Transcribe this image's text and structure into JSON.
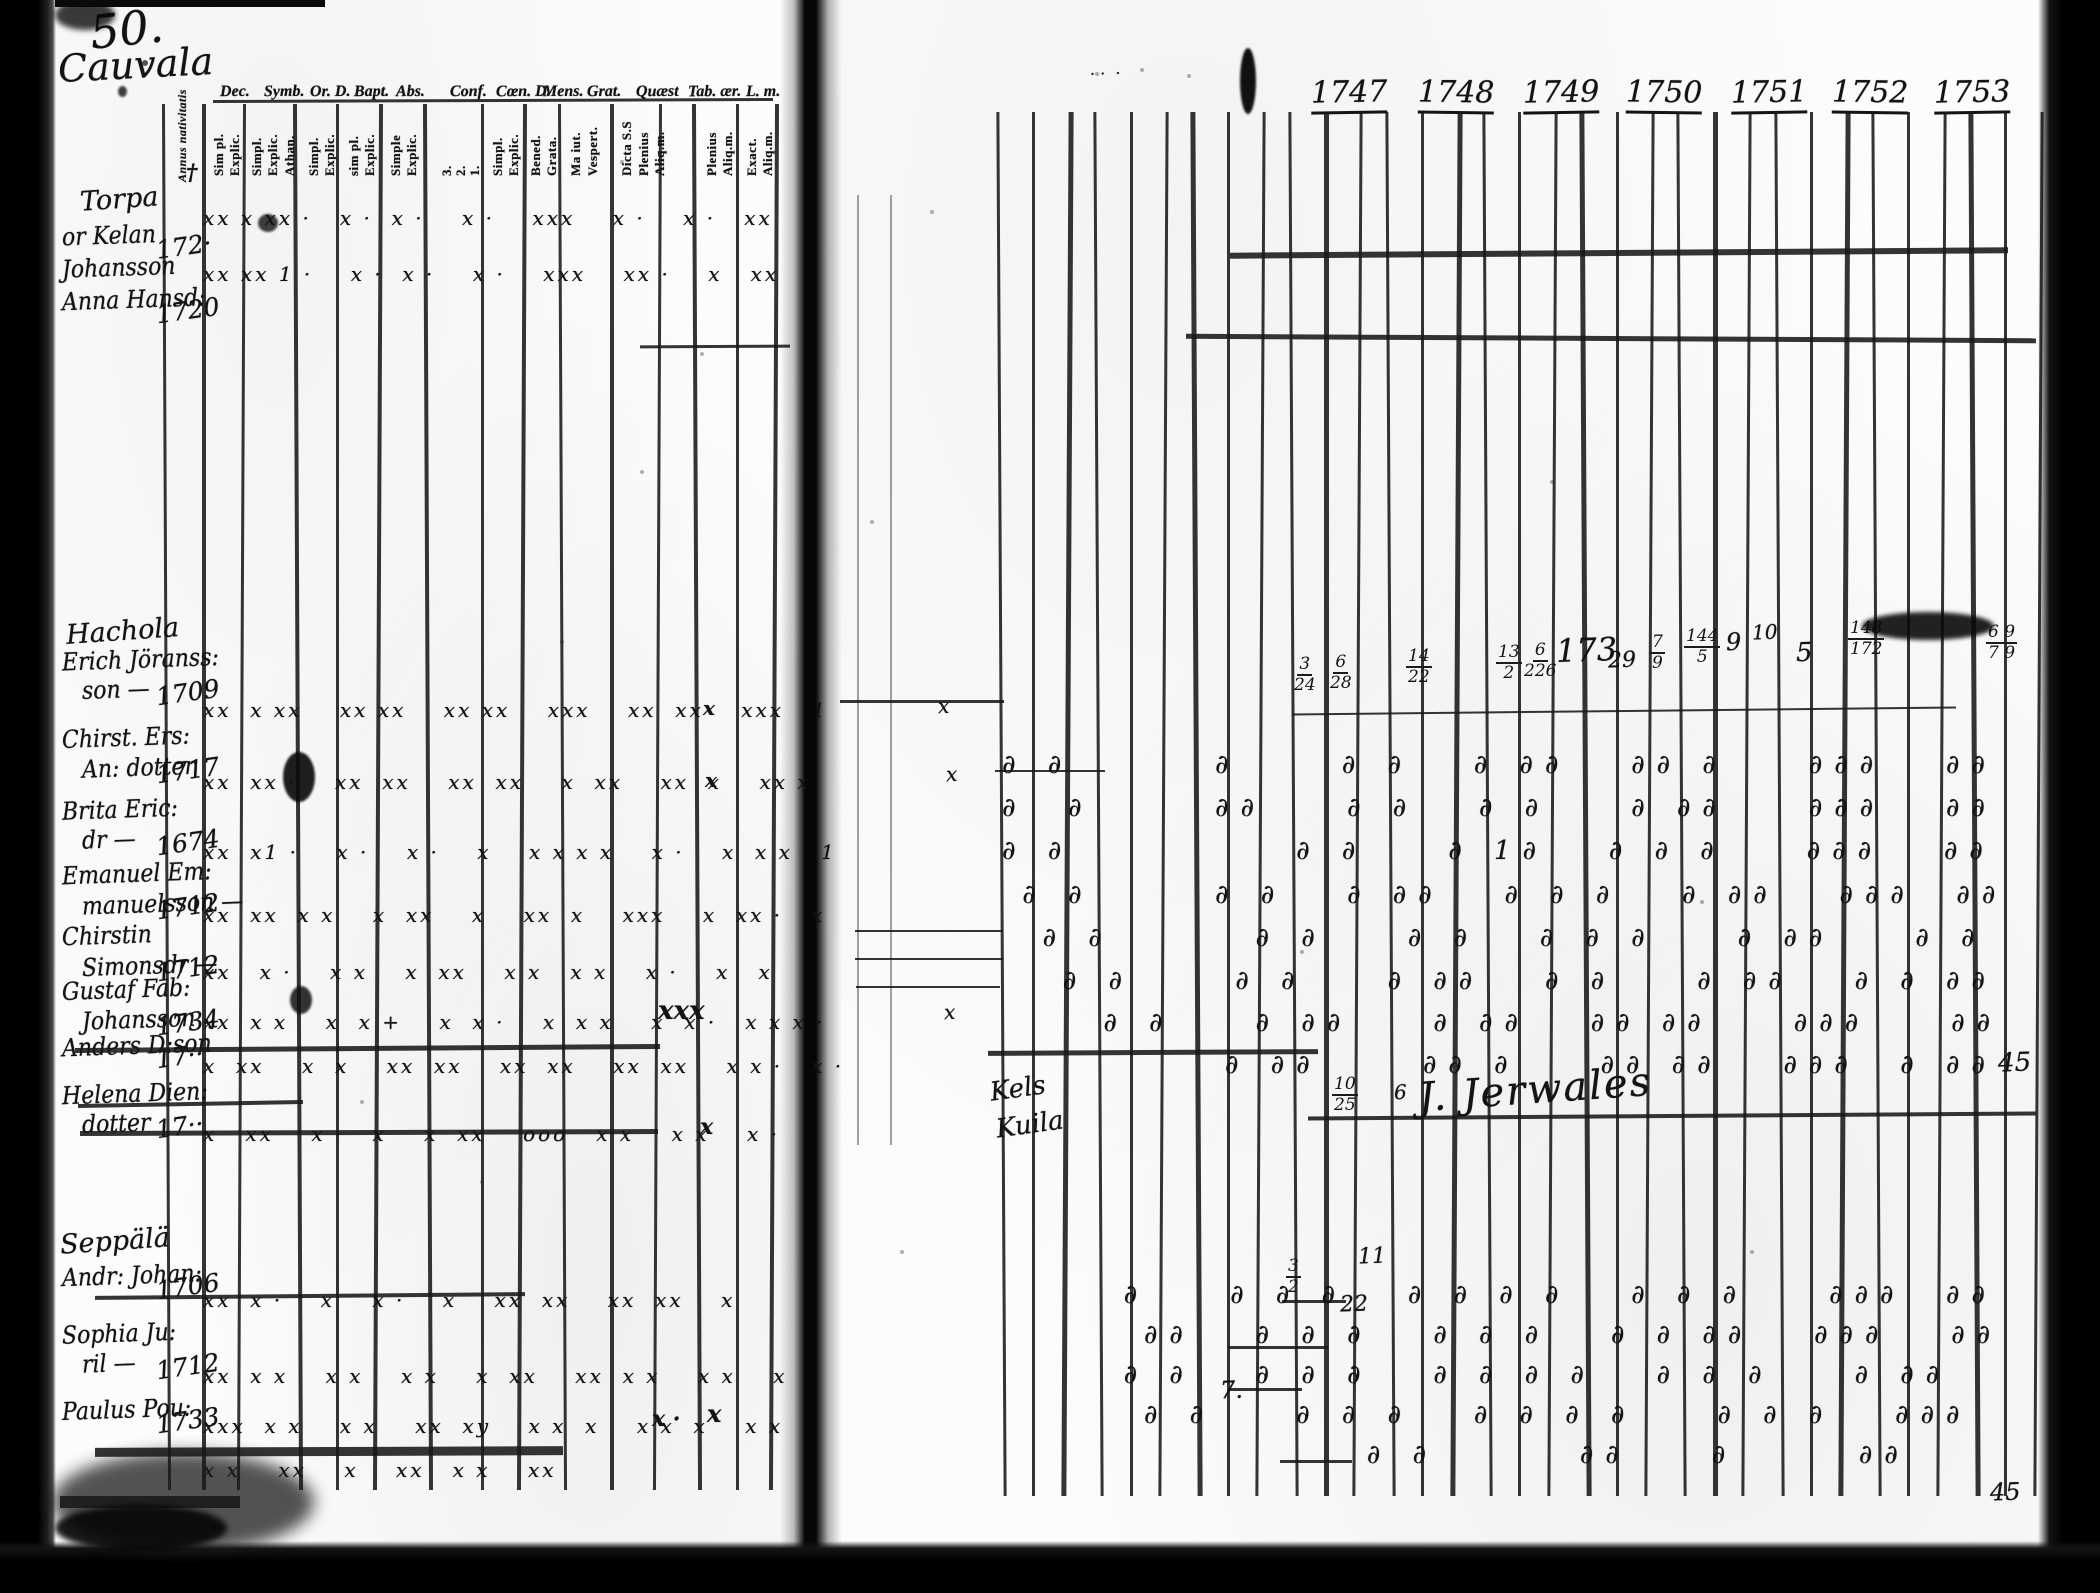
{
  "scan": {
    "page_number": "50.",
    "place_title": "Cauvala",
    "left_page": {
      "group_headers": [
        "Dec.",
        "Symb.",
        "Or. D.",
        "Bapt.",
        "Abs.",
        "Conf.",
        "Cœn. D.",
        "Mens.",
        "Grat.",
        "Quæst",
        "Tab. ær.",
        "L. m."
      ],
      "first_column_label": "Annus nativitatis",
      "sub_headers": [
        "Sim pl.",
        "Explic.",
        "Simpl.",
        "Explic.",
        "Athan.",
        "Simpl.",
        "Explic.",
        "sim pl.",
        "Explic.",
        "Simple",
        "Explic.",
        "3.",
        "2.",
        "1.",
        "Simpl.",
        "Explic.",
        "Bened.",
        "Grata.",
        "Ma iut.",
        "Vespert.",
        "Dicta S.S",
        "Plenius",
        "Aliq.m.",
        "Plenius",
        "Aliq.m.",
        "Exact.",
        "Aliq.m."
      ],
      "groups": [
        {
          "heading": "Torpa",
          "x": 80,
          "y": 186,
          "rows": [
            {
              "name_lines": [
                "or Kelan"
              ],
              "year": "172·",
              "y": 226,
              "marks": "xx x xx ·   x ·  x ·    x ·    xxx    x ·    x ·   xx",
              "marks_y": 208
            },
            {
              "name_lines": [
                "Johansson"
              ],
              "year": "",
              "y": 258,
              "marks": "",
              "marks_y": 0
            },
            {
              "name_lines": [
                "Anna Hansd:"
              ],
              "year": "1720",
              "y": 290,
              "marks": "xx xx 1 ·    x ·  x ·    x ·    xxx    xx ·    x   xx",
              "marks_y": 264
            }
          ]
        },
        {
          "heading": "Hachola",
          "x": 66,
          "y": 618,
          "rows": [
            {
              "name_lines": [
                "Erich Jöranss:",
                "son —"
              ],
              "year": "1709",
              "y": 650,
              "marks": "xx  x xx    xx xx    xx xx    xxx    xx  xx    xxx   1",
              "marks_y": 700
            },
            {
              "name_lines": [
                "Chirst. Ers:",
                "An: dotter"
              ],
              "year": "1717",
              "y": 728,
              "marks": "xx  xx ·    xx  xx    xx  xx    x  xx    xx  x    xx x",
              "marks_y": 772
            },
            {
              "name_lines": [
                "Brita Eric:",
                "dr —"
              ],
              "year": "1674",
              "y": 800,
              "marks": "xx  x1 ·    x ·    x ·    x    x x x x    x ·    x  x x   1",
              "marks_y": 842
            },
            {
              "name_lines": [
                "Emanuel Em:",
                "manuelsson —"
              ],
              "year": "1712",
              "y": 864,
              "marks": "xx  xx  x x    x  xx    x    xx  x    xxx    x  xx ·   x",
              "marks_y": 905
            },
            {
              "name_lines": [
                "Chirstin",
                "Simonsdr —"
              ],
              "year": "1712",
              "y": 926,
              "marks": "xx   x ·    x x    x  xx    x x   x x    x ·    x   x",
              "marks_y": 962
            },
            {
              "name_lines": [
                "Gustaf Fab:",
                "Johansson"
              ],
              "year": "1734",
              "y": 980,
              "marks": "xx  x x    x  x +    x  x ·    x  x x    x  x ·   x x x ·",
              "marks_y": 1012
            },
            {
              "name_lines": [
                "Anders D:son"
              ],
              "year": "17··",
              "y": 1036,
              "struck": true,
              "marks": "x  xx    x  x    xx  xx    xx  xx    xx  xx    x x ·   x ·",
              "marks_y": 1056
            },
            {
              "name_lines": [
                "Helena Dien:",
                "dotter"
              ],
              "year": "17··",
              "y": 1084,
              "struck": true,
              "marks": "x   xx    x ·   x    x  xx    ooo   x x    x x    x ·",
              "marks_y": 1124
            }
          ]
        },
        {
          "heading": "Seppälä",
          "x": 60,
          "y": 1228,
          "rows": [
            {
              "name_lines": [
                "Andr: Johan:"
              ],
              "year": "1706",
              "y": 1266,
              "struck": true,
              "marks": "xx  x ·    x    x ·    x    xx  xx    xx  xx    x",
              "marks_y": 1290
            },
            {
              "name_lines": [
                "Sophia Ju:",
                "ril —"
              ],
              "year": "1712",
              "y": 1324,
              "marks": "xx  x x    x x    x x    x  xx    xx  x x    x x    x",
              "marks_y": 1366
            },
            {
              "name_lines": [
                "Paulus Pou:"
              ],
              "year": "1733",
              "y": 1400,
              "marks": "xxx  x x    x x    xx  xy    x x  x    x x  x    x x",
              "marks_y": 1416
            },
            {
              "name_lines": [],
              "year": "",
              "y": 1458,
              "marks": "x x    xx    x    xx   x x    xx",
              "marks_y": 1460
            }
          ]
        }
      ],
      "extra_marks": [
        {
          "t": "†",
          "x": 186,
          "y": 162,
          "s": 22
        },
        {
          "t": "xxx",
          "x": 658,
          "y": 998,
          "s": 26
        },
        {
          "t": "x",
          "x": 703,
          "y": 698,
          "s": 20
        },
        {
          "t": "x",
          "x": 705,
          "y": 770,
          "s": 20
        },
        {
          "t": "x",
          "x": 700,
          "y": 1116,
          "s": 22
        },
        {
          "t": "x ·",
          "x": 652,
          "y": 1408,
          "s": 22
        },
        {
          "t": "x",
          "x": 707,
          "y": 1402,
          "s": 24
        }
      ]
    },
    "right_page": {
      "years": [
        "1747",
        "1748",
        "1749",
        "1750",
        "1751",
        "1752",
        "1753"
      ],
      "communion_rows": [
        {
          "y": 752,
          "pattern": "∂ ∂       ∂     ∂ ∂   ∂ ∂∂   ∂∂ ∂    ∂∂∂   ∂∂"
        },
        {
          "y": 795,
          "pattern": "∂  ∂      ∂∂    ∂ ∂   ∂ ∂    ∂ ∂∂    ∂∂∂   ∂∂"
        },
        {
          "y": 838,
          "pattern": "∂ ∂           ∂ ∂    ∂ 1∂   ∂ ∂ ∂    ∂∂∂   ∂∂"
        },
        {
          "y": 882,
          "pattern": " ∂ ∂      ∂ ∂   ∂ ∂∂   ∂ ∂ ∂   ∂ ∂∂   ∂∂∂  ∂∂"
        },
        {
          "y": 925,
          "pattern": "  ∂ ∂       ∂ ∂    ∂ ∂   ∂ ∂ ∂    ∂ ∂∂    ∂ ∂"
        },
        {
          "y": 968,
          "pattern": "   ∂ ∂     ∂ ∂    ∂ ∂∂   ∂ ∂    ∂ ∂∂   ∂ ∂ ∂∂"
        },
        {
          "y": 1010,
          "pattern": "     ∂ ∂    ∂ ∂∂    ∂ ∂∂   ∂∂ ∂∂    ∂∂∂    ∂∂"
        },
        {
          "y": 1052,
          "pattern": "           ∂ ∂∂     ∂∂ ∂    ∂∂ ∂∂   ∂∂∂  ∂ ∂∂"
        },
        {
          "y": 1282,
          "pattern": "      ∂    ∂ ∂ ∂   ∂ ∂ ∂ ∂   ∂ ∂ ∂    ∂∂∂  ∂∂"
        },
        {
          "y": 1322,
          "pattern": "       ∂∂   ∂ ∂ ∂   ∂ ∂ ∂   ∂ ∂ ∂∂   ∂∂∂   ∂∂"
        },
        {
          "y": 1362,
          "pattern": "      ∂ ∂   ∂ ∂ ∂   ∂ ∂ ∂ ∂   ∂ ∂ ∂    ∂ ∂∂  "
        },
        {
          "y": 1402,
          "pattern": "       ∂ ∂    ∂ ∂ ∂   ∂ ∂ ∂ ∂    ∂ ∂ ∂   ∂∂∂ "
        },
        {
          "y": 1442,
          "pattern": "                  ∂ ∂       ∂∂    ∂      ∂∂  "
        }
      ],
      "fractions": [
        {
          "num": "3",
          "den": "24",
          "x": 1294,
          "y": 656
        },
        {
          "num": "6",
          "den": "28",
          "x": 1330,
          "y": 654
        },
        {
          "num": "14",
          "den": "22",
          "x": 1406,
          "y": 648
        },
        {
          "num": "13",
          "den": "2",
          "x": 1496,
          "y": 644
        },
        {
          "num": "6",
          "den": "226",
          "x": 1524,
          "y": 642
        },
        {
          "num": "7",
          "den": "9",
          "x": 1650,
          "y": 634
        },
        {
          "num": "144",
          "den": "5",
          "x": 1684,
          "y": 628
        },
        {
          "num": "148",
          "den": "172",
          "x": 1848,
          "y": 620
        },
        {
          "num": "6 9",
          "den": "7 9",
          "x": 1986,
          "y": 624
        },
        {
          "num": "10",
          "den": "25",
          "x": 1332,
          "y": 1076
        },
        {
          "num": "3",
          "den": "2",
          "x": 1286,
          "y": 1258
        }
      ],
      "annotations": [
        {
          "t": "173",
          "x": 1556,
          "y": 634,
          "s": 32
        },
        {
          "t": "29",
          "x": 1608,
          "y": 650,
          "s": 22
        },
        {
          "t": "9",
          "x": 1726,
          "y": 630,
          "s": 24
        },
        {
          "t": "10",
          "x": 1752,
          "y": 622,
          "s": 20
        },
        {
          "t": "5",
          "x": 1796,
          "y": 640,
          "s": 26
        },
        {
          "t": "6",
          "x": 1394,
          "y": 1082,
          "s": 20
        },
        {
          "t": "11",
          "x": 1358,
          "y": 1246,
          "s": 22
        },
        {
          "t": "22",
          "x": 1340,
          "y": 1294,
          "s": 22
        },
        {
          "t": "7.",
          "x": 1220,
          "y": 1378,
          "s": 24
        },
        {
          "t": "45",
          "x": 1998,
          "y": 1050,
          "s": 26
        },
        {
          "t": "45",
          "x": 1990,
          "y": 1480,
          "s": 24
        },
        {
          "t": "x",
          "x": 938,
          "y": 696,
          "s": 20
        },
        {
          "t": "x",
          "x": 946,
          "y": 764,
          "s": 20
        },
        {
          "t": "x",
          "x": 944,
          "y": 1002,
          "s": 20
        },
        {
          "t": "· ·  ·",
          "x": 1090,
          "y": 66,
          "s": 16
        }
      ],
      "signature": {
        "t": "J. Jerwales",
        "x": 1418,
        "y": 1070,
        "s": 40,
        "r": -4
      },
      "margin_note": {
        "lines": [
          "Kels",
          "Kuila"
        ],
        "x": 990,
        "y": 1076
      }
    }
  }
}
